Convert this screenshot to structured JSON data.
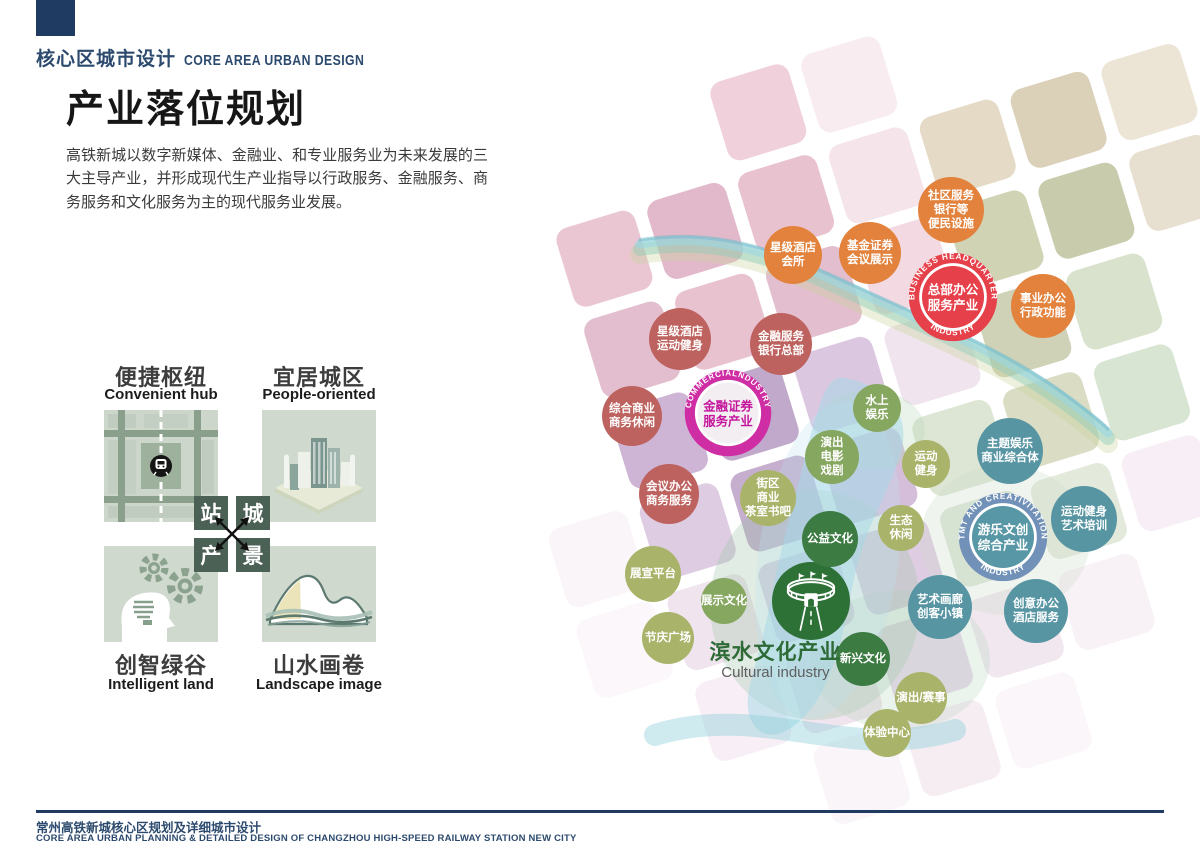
{
  "header": {
    "kicker_zh": "核心区城市设计",
    "kicker_en": "CORE AREA URBAN DESIGN",
    "title": "产业落位规划",
    "intro": "高铁新城以数字新媒体、金融业、和专业服务业为未来发展的三大主导产业，并形成现代生产业指导以行政服务、金融服务、商务服务和文化服务为主的现代服务业发展。"
  },
  "concepts": {
    "items": [
      {
        "zh": "便捷枢纽",
        "en": "Convenient hub",
        "icon": "transit-map-icon"
      },
      {
        "zh": "宜居城区",
        "en": "People-oriented",
        "icon": "city-buildings-icon"
      },
      {
        "zh": "创智绿谷",
        "en": "Intelligent land",
        "icon": "mind-gears-icon"
      },
      {
        "zh": "山水画卷",
        "en": "Landscape image",
        "icon": "mountains-icon"
      }
    ],
    "cross": {
      "tl": "站",
      "tr": "城",
      "bl": "产",
      "br": "景"
    }
  },
  "map": {
    "water_label_zh": "滨水文化产业",
    "water_label_en": "Cultural industry",
    "hubs": [
      {
        "id": "business-headquarter",
        "x": 953,
        "y": 297,
        "r": 47,
        "arc_top": "BUSINESS HEADQUARTER",
        "arc_bottom": "INDUSTRY",
        "line1": "总部办公",
        "line2": "服务产业",
        "ring": "#e6404a",
        "inner": "#e6404a",
        "text_color": "#ffffff"
      },
      {
        "id": "commercial-industry",
        "x": 728,
        "y": 413,
        "r": 46,
        "arc_top": "COMMERCIALNDUSTRY",
        "arc_bottom": "",
        "line1": "金融证券",
        "line2": "服务产业",
        "ring": "#cf2da4",
        "inner": "#f3eef2",
        "text_color": "#c4169c"
      },
      {
        "id": "tmt-creative",
        "x": 1003,
        "y": 537,
        "r": 47,
        "arc_top": "TMT AND CREATIVITATION",
        "arc_bottom": "INDUSTRY",
        "line1": "游乐文创",
        "line2": "综合产业",
        "ring": "#7291b8",
        "inner": "#5897a5",
        "text_color": "#ffffff"
      }
    ],
    "bubbles": [
      {
        "id": "community-services",
        "text": "社区服务\n银行等\n便民设施",
        "x": 951,
        "y": 210,
        "r": 33,
        "color": "orange"
      },
      {
        "id": "fund-securities",
        "text": "基金证券\n会议展示",
        "x": 870,
        "y": 253,
        "r": 31,
        "color": "orange"
      },
      {
        "id": "hotel-club",
        "text": "星级酒店\n会所",
        "x": 793,
        "y": 255,
        "r": 29,
        "color": "orange"
      },
      {
        "id": "admin-office",
        "text": "事业办公\n行政功能",
        "x": 1043,
        "y": 306,
        "r": 32,
        "color": "orange"
      },
      {
        "id": "hotel-fitness",
        "text": "星级酒店\n运动健身",
        "x": 680,
        "y": 339,
        "r": 31,
        "color": "brick"
      },
      {
        "id": "finance-bank-hq",
        "text": "金融服务\n银行总部",
        "x": 781,
        "y": 344,
        "r": 31,
        "color": "brick"
      },
      {
        "id": "commercial-leisure",
        "text": "综合商业\n商务休闲",
        "x": 632,
        "y": 416,
        "r": 30,
        "color": "brick"
      },
      {
        "id": "conference-office",
        "text": "会议办公\n商务服务",
        "x": 669,
        "y": 494,
        "r": 30,
        "color": "brick"
      },
      {
        "id": "water-recreation",
        "text": "水上\n娱乐",
        "x": 877,
        "y": 408,
        "r": 24,
        "color": "green"
      },
      {
        "id": "performance-cinema",
        "text": "演出\n电影\n戏剧",
        "x": 832,
        "y": 457,
        "r": 27,
        "color": "green"
      },
      {
        "id": "sports-fitness",
        "text": "运动\n健身",
        "x": 926,
        "y": 464,
        "r": 24,
        "color": "olive"
      },
      {
        "id": "theme-entertainment",
        "text": "主题娱乐\n商业综合体",
        "x": 1010,
        "y": 451,
        "r": 33,
        "color": "teal"
      },
      {
        "id": "block-commerce",
        "text": "街区\n商业\n茶室书吧",
        "x": 768,
        "y": 498,
        "r": 28,
        "color": "olive"
      },
      {
        "id": "stadium",
        "text": "",
        "x": 811,
        "y": 601,
        "r": 39,
        "color": "stadium",
        "icon": "stadium"
      },
      {
        "id": "public-culture",
        "text": "公益文化",
        "x": 830,
        "y": 539,
        "r": 28,
        "color": "darkgreen"
      },
      {
        "id": "eco-leisure",
        "text": "生态\n休闲",
        "x": 901,
        "y": 528,
        "r": 23,
        "color": "olive"
      },
      {
        "id": "sports-art-training",
        "text": "运动健身\n艺术培训",
        "x": 1084,
        "y": 519,
        "r": 33,
        "color": "teal"
      },
      {
        "id": "exhibition-platform",
        "text": "展宣平台",
        "x": 653,
        "y": 574,
        "r": 28,
        "color": "olive"
      },
      {
        "id": "display-culture",
        "text": "展示文化",
        "x": 724,
        "y": 601,
        "r": 23,
        "color": "green"
      },
      {
        "id": "festival-plaza",
        "text": "节庆广场",
        "x": 668,
        "y": 638,
        "r": 26,
        "color": "olive"
      },
      {
        "id": "emerging-culture",
        "text": "新兴文化",
        "x": 863,
        "y": 659,
        "r": 27,
        "color": "darkgreen"
      },
      {
        "id": "art-gallery-town",
        "text": "艺术画廊\n创客小镇",
        "x": 940,
        "y": 607,
        "r": 32,
        "color": "teal"
      },
      {
        "id": "creative-office",
        "text": "创意办公\n酒店服务",
        "x": 1036,
        "y": 611,
        "r": 32,
        "color": "teal"
      },
      {
        "id": "performance-events",
        "text": "演出/赛事",
        "x": 921,
        "y": 698,
        "r": 26,
        "color": "olive"
      },
      {
        "id": "experience-center",
        "text": "体验中心",
        "x": 887,
        "y": 733,
        "r": 24,
        "color": "olive"
      }
    ]
  },
  "palette": {
    "orange": "#e2823c",
    "brick": "#bd625e",
    "green": "#86a760",
    "olive": "#a9b369",
    "darkgreen": "#3c7b42",
    "teal": "#5795a3",
    "stadium": "#2e7137",
    "navy": "#203b61",
    "hub_red": "#e6404a",
    "hub_magenta": "#cf2da4",
    "hub_blue_ring": "#7291b8"
  },
  "footer": {
    "zh": "常州高铁新城核心区规划及详细城市设计",
    "en": "CORE AREA URBAN PLANNING & DETAILED DESIGN OF CHANGZHOU HIGH-SPEED RAILWAY STATION NEW CITY"
  }
}
